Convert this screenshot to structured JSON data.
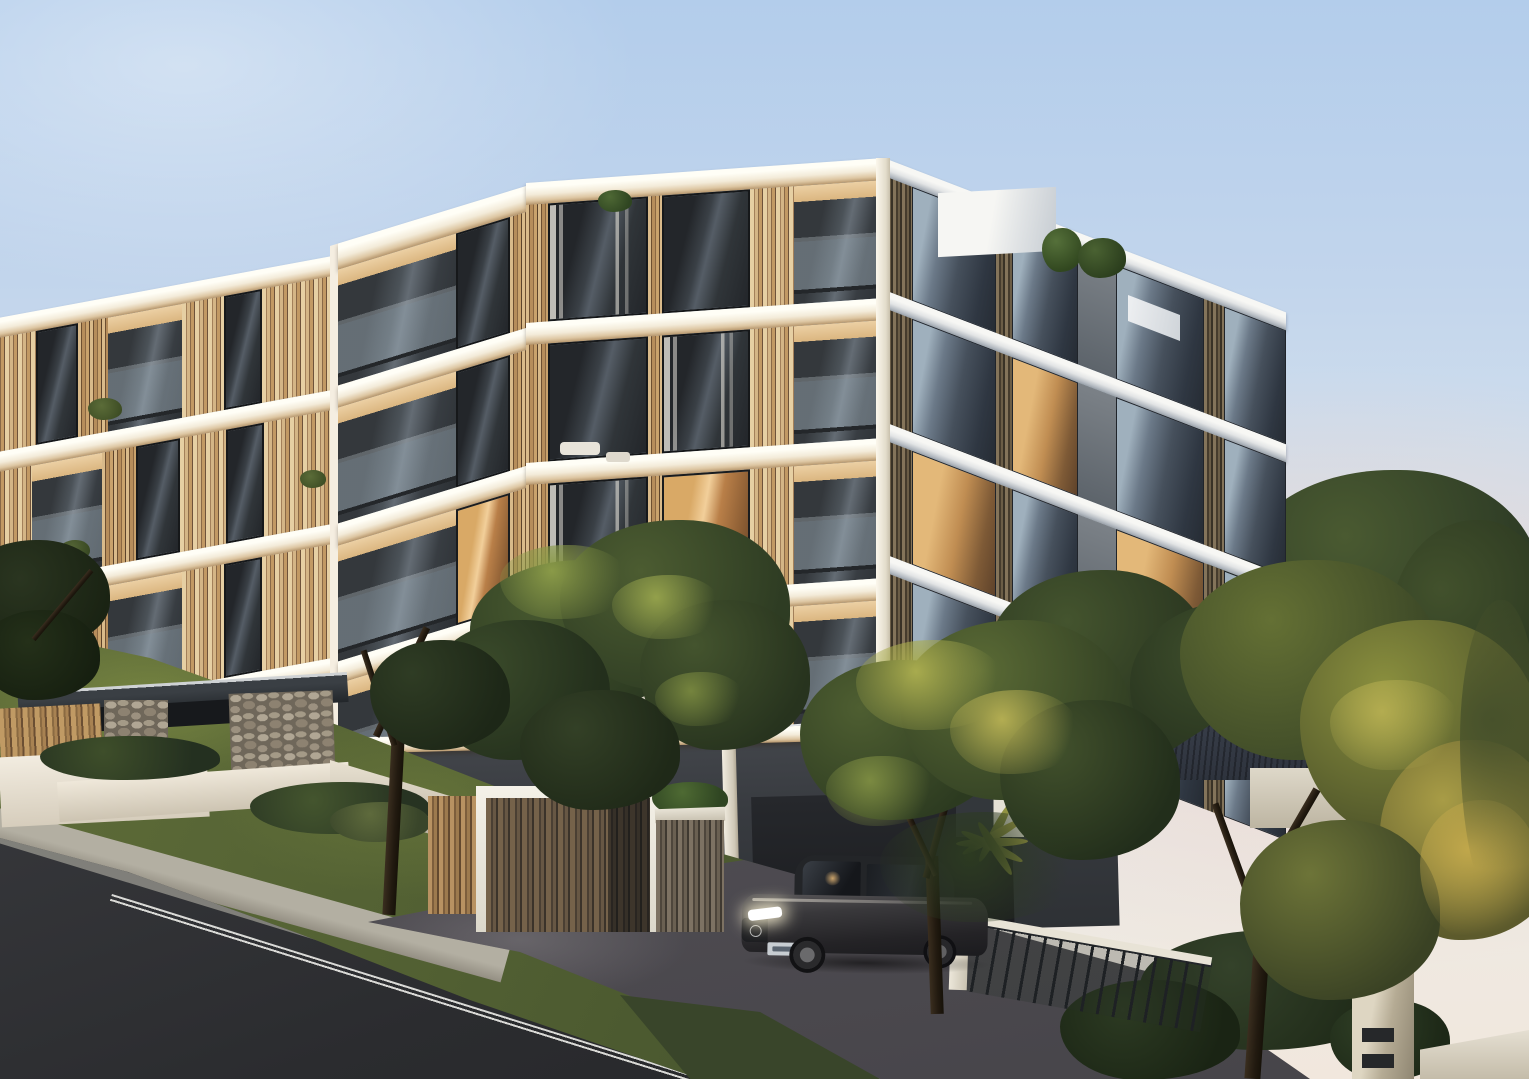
{
  "scene": {
    "type": "architectural-exterior-render",
    "time_of_day": "dusk",
    "description": "Photorealistic dusk render of a modern five-storey apartment building with white concrete floor slabs, vertical timber battens, glass balustrades and charcoal cladding, set on a sloping street. Foreground shows an asphalt road with double white edge line, concrete footpath, grass verge, paved driveway with a parked dark sedan with headlights on, stacked-stone entry piers, timber fences, a white-framed timber gate, landscaped trees and palms, a neighbouring house with dark hipped roof, and a rendered front pier with a spherical lamp and letterbox slots.",
    "building": {
      "storeys_visible": 5,
      "wings": [
        "left wing",
        "corner bay",
        "main street face",
        "receding right face"
      ],
      "materials": [
        "white concrete slabs",
        "golden timber battens",
        "glass balustrades",
        "charcoal cladding",
        "stacked stone",
        "floor-to-ceiling glazing"
      ],
      "rooftop": [
        "white roof-access box",
        "rooftop shrubs"
      ]
    },
    "vehicle": {
      "type": "sedan",
      "colour": "#35343a",
      "headlights": "on",
      "license_plate": "illegible"
    },
    "street": {
      "road_marking": "double white edge line",
      "surfaces": [
        "asphalt road",
        "concrete footpath",
        "grass verge",
        "paved driveway"
      ]
    },
    "landscape": [
      "large street tree",
      "tree beside driveway",
      "sunlit trees at right",
      "dark background trees",
      "palm fronds",
      "hedges",
      "agave shrubs",
      "grass bank"
    ],
    "fencing": [
      "timber batten fence",
      "white retaining walls",
      "black metal picket fence",
      "white fence pier",
      "lamp-and-letterbox pier"
    ],
    "neighbour_house": {
      "roof": "dark corrugated hip roof",
      "walls": "cream render"
    },
    "palette": {
      "sky_top": "#b3cdeb",
      "sky_horizon_warm": "#f1e7dd",
      "slab_white": "#f3ebd9",
      "slab_cool": "#e2e4e5",
      "timber_light": "#d9ba8a",
      "timber_dark": "#6d4f31",
      "charcoal_wall": "#3b3e42",
      "glass_cool": "#46505c",
      "interior_glow": "#f2cf9a",
      "grass": "#4c5a30",
      "road_asphalt": "#2b2c2f",
      "foliage_dark": "#2f3d26",
      "foliage_sunlit": "#a8ab4e",
      "stone": "#958b7b",
      "lamp_globe": "#fffef6"
    }
  }
}
